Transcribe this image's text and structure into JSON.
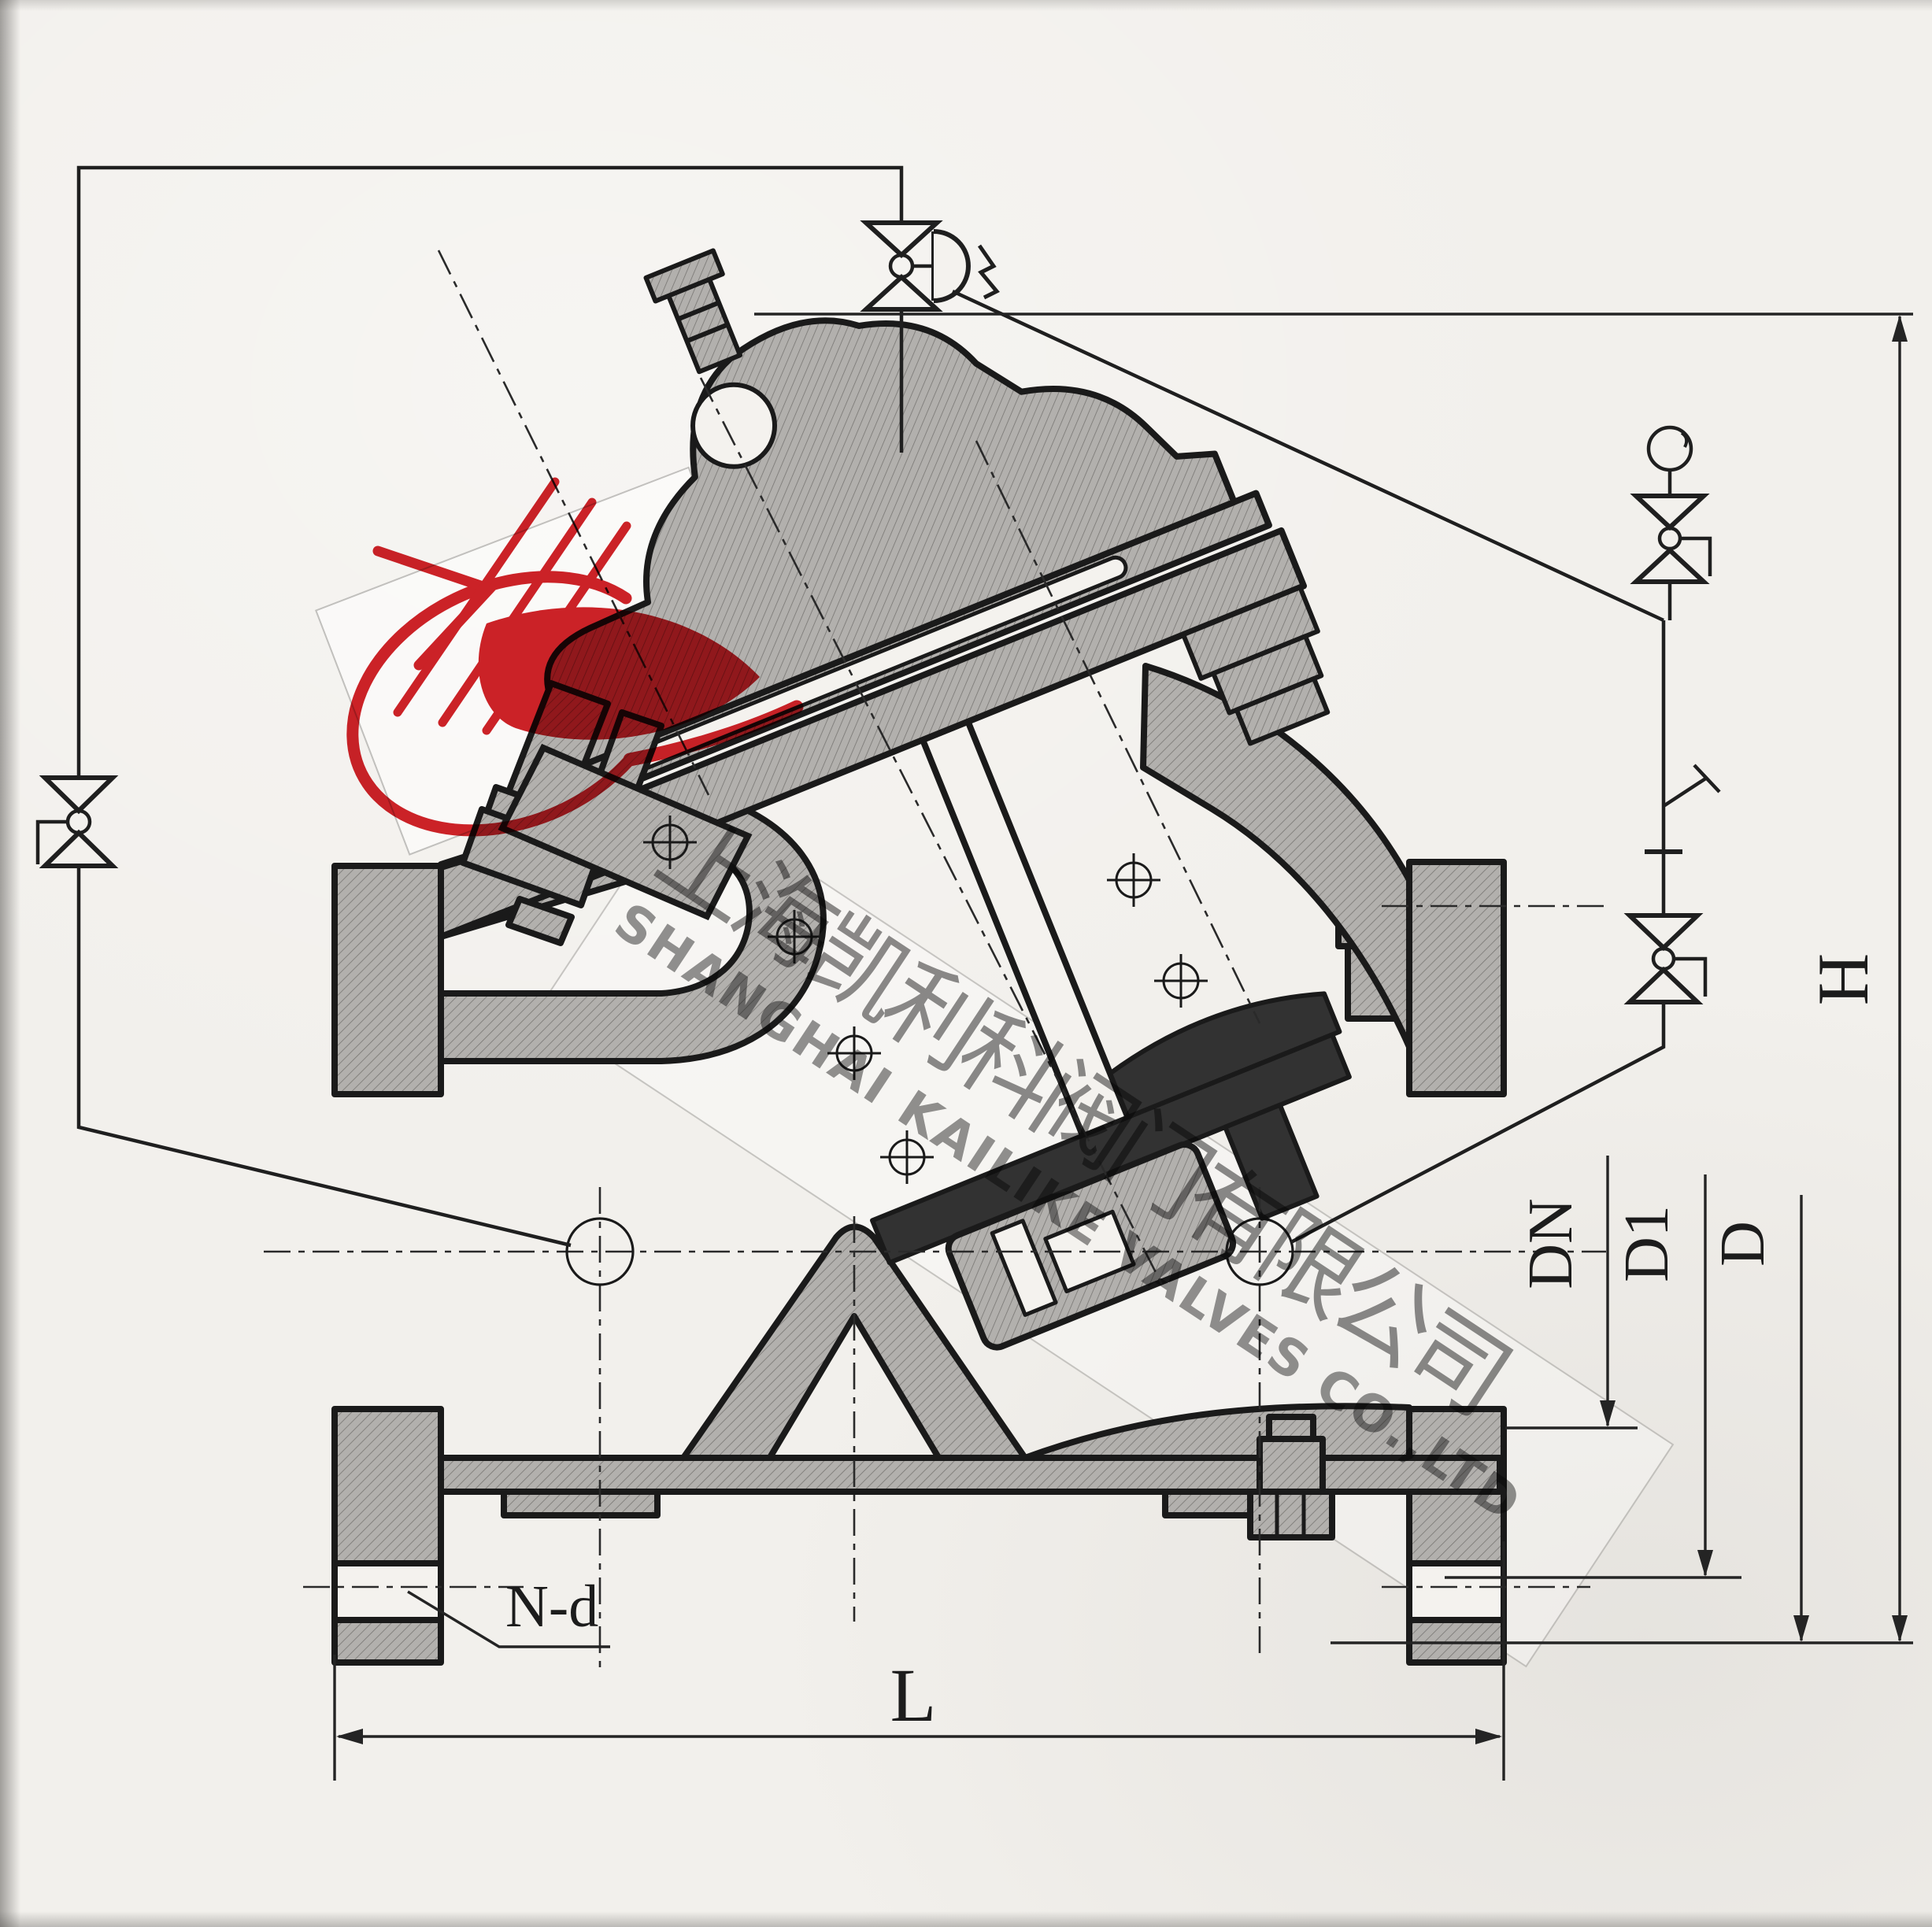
{
  "drawing": {
    "kind": "valve cross-section engineering drawing",
    "labels": {
      "height": "H",
      "length": "L",
      "flange_outside_diameter": "D",
      "bolt_circle_diameter": "D1",
      "nominal_diameter": "DN",
      "bolt_holes": "N-d"
    }
  },
  "watermark": {
    "company_cn": "上海凯利科阀门有限公司",
    "company_en": "SHANGHAI KAILIKE VALVES CO.,LTD"
  },
  "logo": {
    "registered_mark": "®",
    "color_red": "#cf2228"
  },
  "colors": {
    "paper": "#f2f0ec",
    "line": "#1a1a1a",
    "casting_fill": "#b2b0ad",
    "hatch_line": "#787673",
    "dark_parts": "#323232",
    "watermark_gray": "#8d8d8d"
  }
}
